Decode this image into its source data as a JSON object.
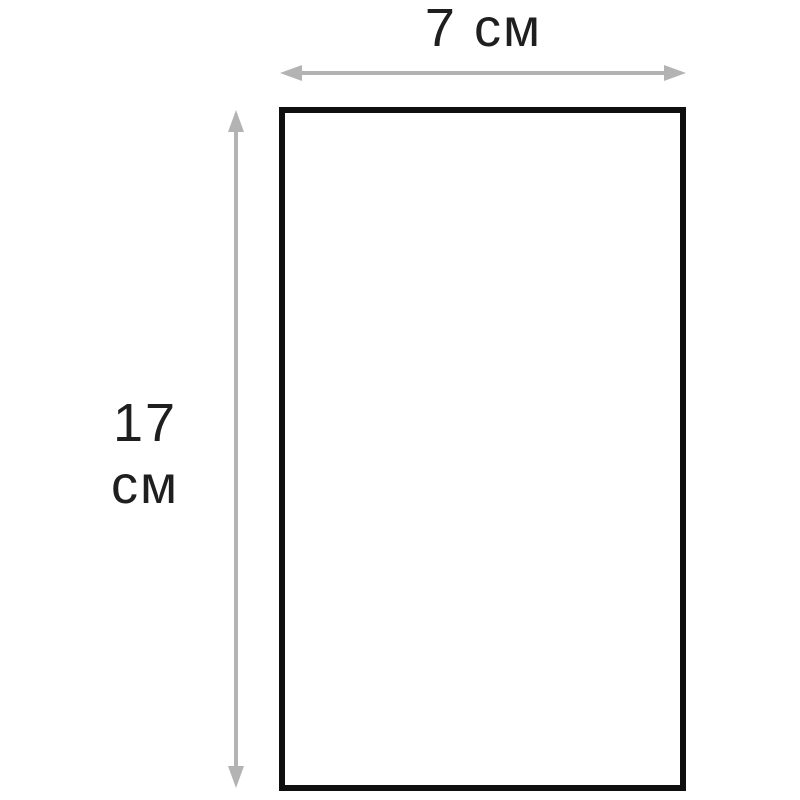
{
  "diagram": {
    "shape": "rectangle",
    "width_label": "7 см",
    "height_label_line1": "17",
    "height_label_line2": "см",
    "dimensions": {
      "width_value": 7,
      "height_value": 17,
      "unit": "см"
    },
    "colors": {
      "background": "#ffffff",
      "rect-border": "#0f0f0f",
      "arrow": "#b3b3b3",
      "label-text": "#1f1f1f"
    }
  }
}
